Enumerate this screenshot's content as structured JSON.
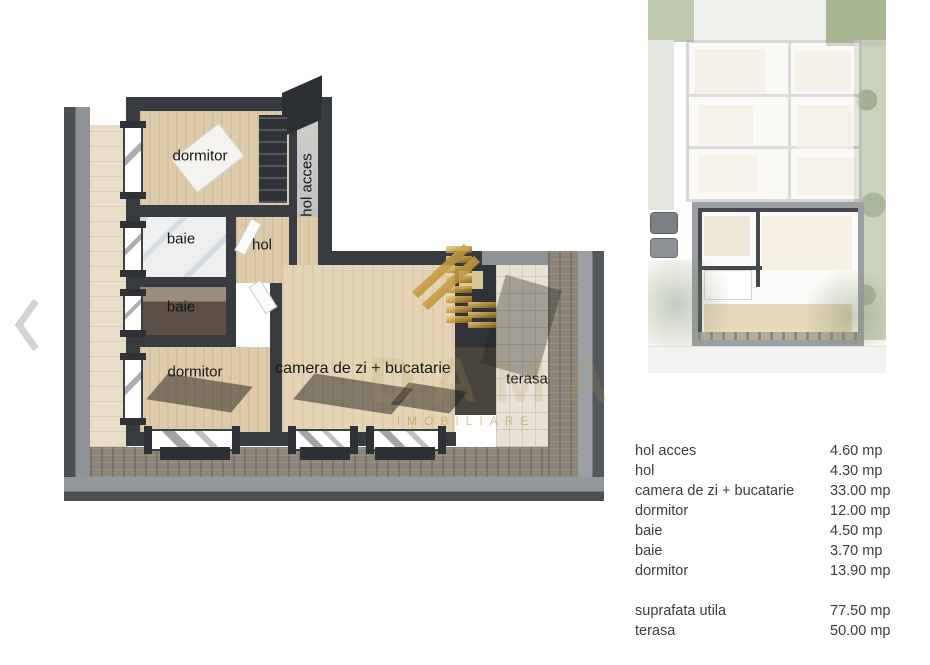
{
  "floor_plan": {
    "rooms": [
      {
        "name": "dormitor"
      },
      {
        "name": "hol acces"
      },
      {
        "name": "baie"
      },
      {
        "name": "hol"
      },
      {
        "name": "baie"
      },
      {
        "name": "dormitor"
      },
      {
        "name": "camera de zi + bucatarie"
      },
      {
        "name": "terasa"
      }
    ]
  },
  "watermark": {
    "brand": "DAMA",
    "subtitle": "IMOBILIARE",
    "accent_gold": "#c49a3f"
  },
  "areas": {
    "rows": [
      {
        "label": "hol acces",
        "value": "4.60 mp"
      },
      {
        "label": "hol",
        "value": "4.30 mp"
      },
      {
        "label": "camera de zi + bucatarie",
        "value": "33.00 mp"
      },
      {
        "label": "dormitor",
        "value": "12.00 mp"
      },
      {
        "label": "baie",
        "value": "4.50 mp"
      },
      {
        "label": "baie",
        "value": "3.70 mp"
      },
      {
        "label": "dormitor",
        "value": "13.90 mp"
      }
    ],
    "summary": [
      {
        "label": "suprafata utila",
        "value": "77.50 mp"
      },
      {
        "label": "terasa",
        "value": "50.00 mp"
      }
    ]
  },
  "colors": {
    "wall": "#383b3f",
    "wood_floor": "#dccaa8",
    "stone_terrace": "#e9e2d4",
    "cobble": "#8d8577",
    "frame_gray": "#8f9397",
    "table_text": "#3c3c3c"
  }
}
